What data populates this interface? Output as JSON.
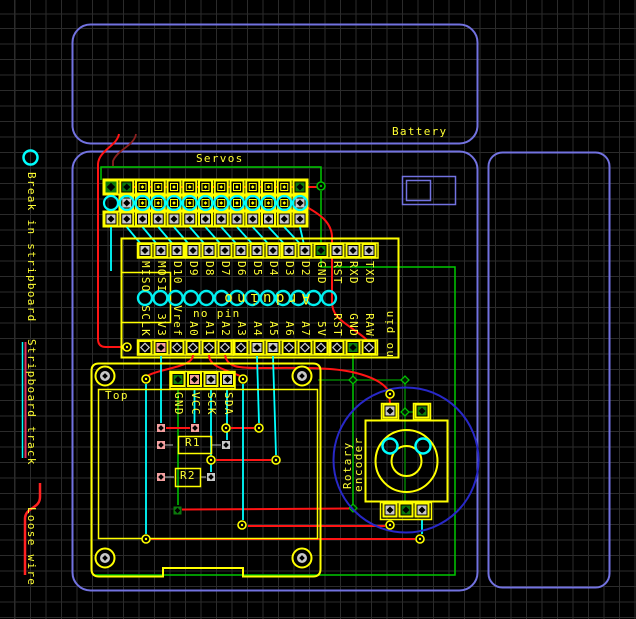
{
  "labels": {
    "battery": "Battery",
    "servos": "Servos",
    "top_board": "Top",
    "arduino": "Arduino",
    "no_pin_h": "no pin",
    "no_pin_v": "no pin",
    "rotary_line1": "Rotary",
    "rotary_line2": "encoder",
    "r1": "R1",
    "r2": "R2"
  },
  "legend": {
    "break_symbol": "break-ring-icon",
    "break": "Break in stripboard",
    "track_symbol": "track-line-icon",
    "track": "Stripboard track",
    "loose_symbol": "loose-wire-icon",
    "loose": "Loose wire"
  },
  "arduino": {
    "top_pins": [
      "MISO",
      "MOSI",
      "D10",
      "D9",
      "D8",
      "D7",
      "D6",
      "D5",
      "D4",
      "D3",
      "D2",
      "GND",
      "RST",
      "RXD",
      "TXD"
    ],
    "bottom_pins": [
      "SCLK",
      "3V3",
      "Vref",
      "A0",
      "A1",
      "A2",
      "A3",
      "A4",
      "A5",
      "A6",
      "A7",
      "5V",
      "RST",
      "GND",
      "RAW"
    ],
    "top_special": {
      "green_index": 11
    },
    "bottom_special": {
      "pink_index": 1,
      "grey_indices": [
        7,
        8
      ],
      "green_index": 13
    },
    "pin_circles": 13
  },
  "display_header": {
    "pins": [
      "GND",
      "VCC",
      "SCK",
      "SDA"
    ],
    "pad_colors": [
      "green",
      "pink",
      "grey",
      "grey"
    ]
  },
  "servo_block": {
    "columns": 13,
    "rows": 3
  },
  "colors": {
    "board_yellow": "#ffff00",
    "label_yellow": "#ffff33",
    "wire_red": "#ff1414",
    "wire_dark_red": "#8b2020",
    "wire_cyan": "#00ffff",
    "net_green": "#00c800",
    "net_dark_green": "#008000",
    "case_blue": "#7272e0",
    "knob_blue": "#2828c8",
    "pad_grey": "#c8c8c8",
    "pad_green": "#0c7a0c",
    "pad_pink": "#f4a0a0",
    "grid_grey": "#2b2b2b"
  }
}
